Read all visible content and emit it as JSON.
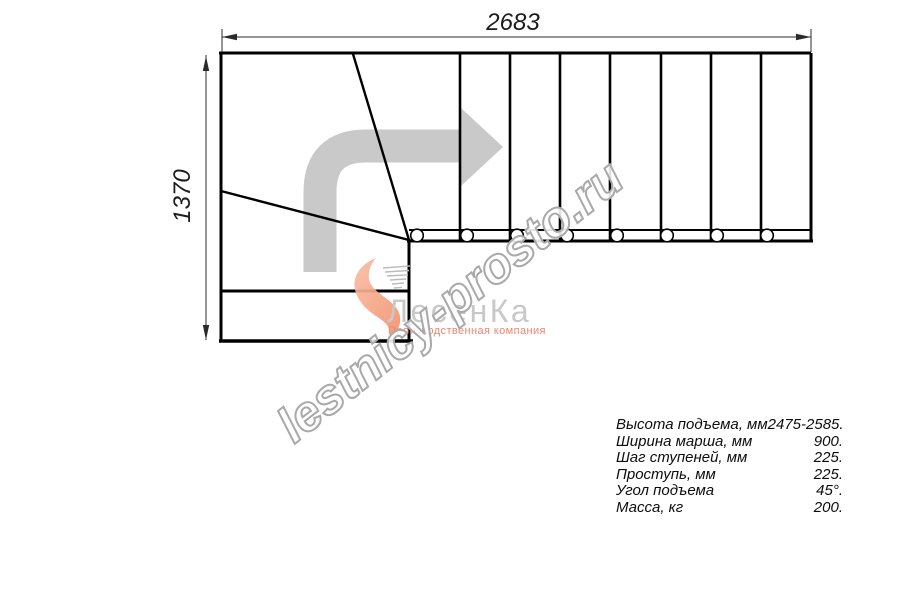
{
  "title": "Staircase plan drawing",
  "dimensions": {
    "width_mm": "2683",
    "height_mm": "1370"
  },
  "watermark": {
    "text": "lestnicy-prosto.ru"
  },
  "logo": {
    "name": "ЛесенКа",
    "tagline": "Производственная компания",
    "mark": "swoosh-icon"
  },
  "direction_arrow": "turn-right-arrow",
  "specs": {
    "rows": [
      {
        "label": "Высота подъема, мм",
        "value": "2475-2585."
      },
      {
        "label": "Ширина марша, мм",
        "value": "900."
      },
      {
        "label": "Шаг ступеней, мм",
        "value": "225."
      },
      {
        "label": "Проступь, мм",
        "value": "225."
      },
      {
        "label": "Угол подъема",
        "value": "45°."
      },
      {
        "label": "Масса, кг",
        "value": "200."
      }
    ]
  },
  "colors": {
    "line": "#000000",
    "dimension": "#2b2b2b",
    "arrow_gray": "#c9c9c9",
    "logo_gray": "#c8c8c8",
    "accent_orange": "#f5a284",
    "tagline_salmon": "#ee8672",
    "watermark_outline": "#a9a9a9"
  }
}
